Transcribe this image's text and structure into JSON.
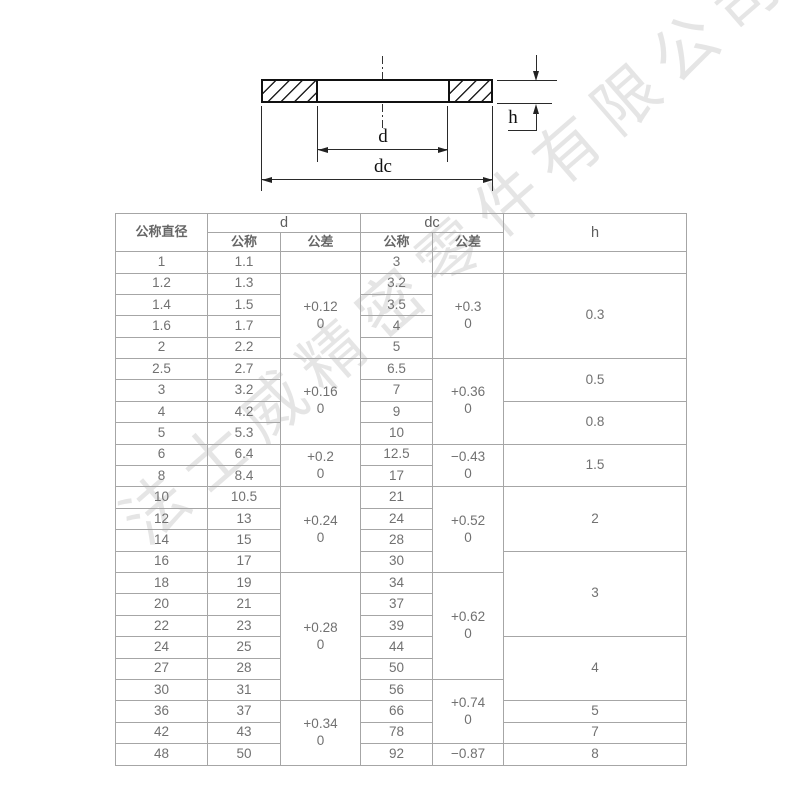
{
  "watermark": {
    "text": "法士威精密零件有限公司",
    "color": "#cccccc"
  },
  "drawing": {
    "labels": {
      "d": "d",
      "dc": "dc",
      "h": "h"
    }
  },
  "table": {
    "header": {
      "nominal_diameter": "公称直径",
      "group_d": "d",
      "group_dc": "dc",
      "group_h": "h",
      "d_nominal": "公称",
      "d_tolerance": "公差",
      "dc_nominal": "公称",
      "dc_tolerance": "公差"
    },
    "rows": [
      {
        "dia": "1",
        "d": "1.1",
        "dc": "3"
      },
      {
        "dia": "1.2",
        "d": "1.3",
        "dc": "3.2"
      },
      {
        "dia": "1.4",
        "d": "1.5",
        "dc": "3.5"
      },
      {
        "dia": "1.6",
        "d": "1.7",
        "dc": "4"
      },
      {
        "dia": "2",
        "d": "2.2",
        "dc": "5"
      },
      {
        "dia": "2.5",
        "d": "2.7",
        "dc": "6.5"
      },
      {
        "dia": "3",
        "d": "3.2",
        "dc": "7"
      },
      {
        "dia": "4",
        "d": "4.2",
        "dc": "9"
      },
      {
        "dia": "5",
        "d": "5.3",
        "dc": "10"
      },
      {
        "dia": "6",
        "d": "6.4",
        "dc": "12.5"
      },
      {
        "dia": "8",
        "d": "8.4",
        "dc": "17"
      },
      {
        "dia": "10",
        "d": "10.5",
        "dc": "21"
      },
      {
        "dia": "12",
        "d": "13",
        "dc": "24"
      },
      {
        "dia": "14",
        "d": "15",
        "dc": "28"
      },
      {
        "dia": "16",
        "d": "17",
        "dc": "30"
      },
      {
        "dia": "18",
        "d": "19",
        "dc": "34"
      },
      {
        "dia": "20",
        "d": "21",
        "dc": "37"
      },
      {
        "dia": "22",
        "d": "23",
        "dc": "39"
      },
      {
        "dia": "24",
        "d": "25",
        "dc": "44"
      },
      {
        "dia": "27",
        "d": "28",
        "dc": "50"
      },
      {
        "dia": "30",
        "d": "31",
        "dc": "56"
      },
      {
        "dia": "36",
        "d": "37",
        "dc": "66"
      },
      {
        "dia": "42",
        "d": "43",
        "dc": "78"
      },
      {
        "dia": "48",
        "d": "50",
        "dc": "92"
      }
    ],
    "merged": {
      "d_tol": [
        {
          "start": 0,
          "span": 1,
          "text": ""
        },
        {
          "start": 1,
          "span": 4,
          "text": "+0.12\n0"
        },
        {
          "start": 5,
          "span": 4,
          "text": "+0.16\n0"
        },
        {
          "start": 9,
          "span": 2,
          "text": "+0.2\n0"
        },
        {
          "start": 11,
          "span": 4,
          "text": "+0.24\n0"
        },
        {
          "start": 15,
          "span": 6,
          "text": "+0.28\n0"
        },
        {
          "start": 21,
          "span": 3,
          "text": "+0.34\n0"
        }
      ],
      "dc_tol": [
        {
          "start": 0,
          "span": 1,
          "text": ""
        },
        {
          "start": 1,
          "span": 4,
          "text": "+0.3\n0"
        },
        {
          "start": 5,
          "span": 4,
          "text": "+0.36\n0"
        },
        {
          "start": 9,
          "span": 2,
          "text": "−0.43\n0"
        },
        {
          "start": 11,
          "span": 4,
          "text": "+0.52\n0"
        },
        {
          "start": 15,
          "span": 5,
          "text": "+0.62\n0"
        },
        {
          "start": 20,
          "span": 3,
          "text": "+0.74\n0"
        },
        {
          "start": 23,
          "span": 1,
          "text": "−0.87"
        }
      ],
      "h": [
        {
          "start": 0,
          "span": 1,
          "text": ""
        },
        {
          "start": 1,
          "span": 4,
          "text": "0.3"
        },
        {
          "start": 5,
          "span": 2,
          "text": "0.5"
        },
        {
          "start": 7,
          "span": 2,
          "text": "0.8"
        },
        {
          "start": 9,
          "span": 2,
          "text": "1.5"
        },
        {
          "start": 11,
          "span": 3,
          "text": "2"
        },
        {
          "start": 14,
          "span": 4,
          "text": "3"
        },
        {
          "start": 18,
          "span": 3,
          "text": "4"
        },
        {
          "start": 21,
          "span": 1,
          "text": "5"
        },
        {
          "start": 22,
          "span": 1,
          "text": "7"
        },
        {
          "start": 23,
          "span": 1,
          "text": "8"
        }
      ]
    }
  }
}
